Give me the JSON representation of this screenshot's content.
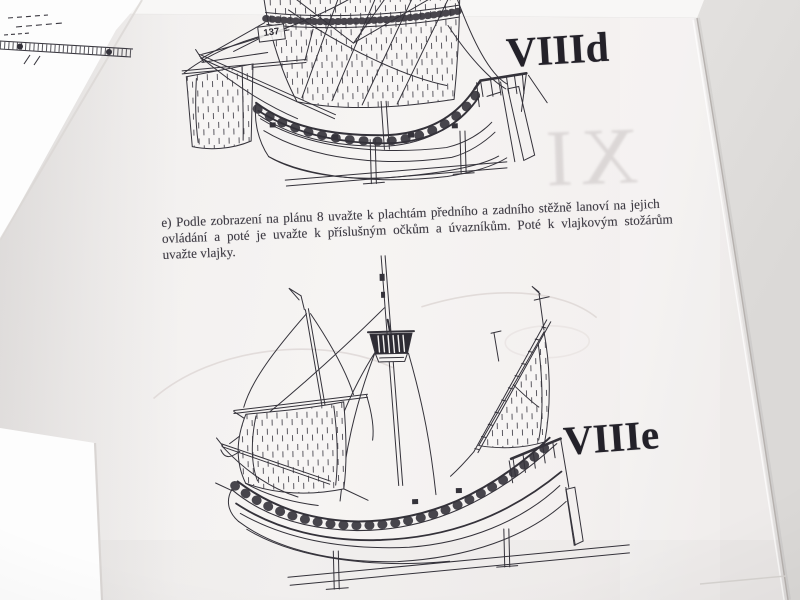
{
  "photo": {
    "colors": {
      "background": "#e5e3e1",
      "page": "#f3f1f0",
      "page_bright": "#fdfdfc",
      "ink": "#34323a"
    }
  },
  "page": {
    "figure_top": {
      "label": "VIIId",
      "part_ref": "137"
    },
    "figure_bottom": {
      "label": "VIIIe"
    },
    "paragraph": {
      "lines": [
        "e) Podle zobrazení na plánu 8 uvažte k plachtám předního a zadního stěžně lanoví na jejich",
        "ovládání a poté je uvažte k příslušným očkům a úvazníkům. Poté k vlajkovým stožárům",
        "uvažte vlajky."
      ]
    },
    "bleedthrough": {
      "numeral": "XI"
    }
  }
}
